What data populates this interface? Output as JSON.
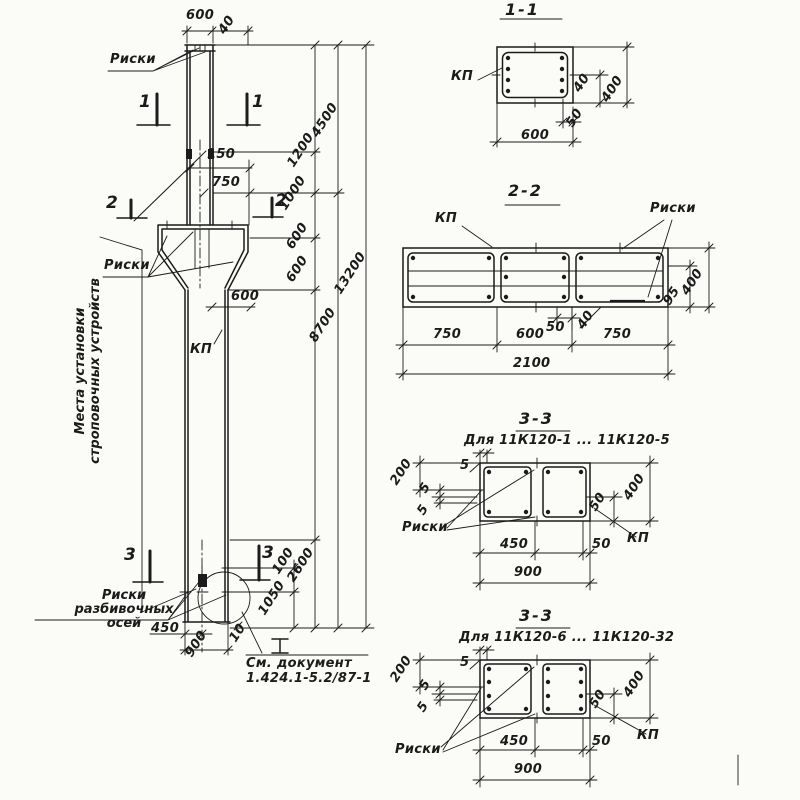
{
  "d": {
    "elev": {
      "w600top": "600",
      "off40": "40",
      "riski_top": "Риски",
      "s1": "1",
      "d150": "150",
      "d750": "750",
      "s2": "2",
      "riski_k": "Риски",
      "w600k": "600",
      "kp": "КП",
      "strop1": "Места установки",
      "strop2": "строповочных устройств",
      "s3": "3",
      "ra1": "Риски",
      "ra2": "разбивочных",
      "ra3": "осей",
      "d450": "450",
      "d900": "900",
      "d10": "10",
      "d100": "100",
      "d1050": "1050",
      "d2600": "2600",
      "d1200": "1200",
      "d1000": "1000",
      "d600a": "600",
      "d600b": "600",
      "d4500": "4500",
      "d8700": "8700",
      "d13200": "13200",
      "doc1": "См. документ",
      "doc2": "1.424.1-5.2/87-1"
    },
    "s11": {
      "title": "1-1",
      "kp": "КП",
      "d40": "40",
      "d400": "400",
      "d50": "50",
      "d600": "600"
    },
    "s22": {
      "title": "2-2",
      "kp": "КП",
      "riski": "Риски",
      "d50": "50",
      "d40": "40",
      "d95": "95",
      "d400": "400",
      "d750a": "750",
      "d600": "600",
      "d750b": "750",
      "d2100": "2100"
    },
    "s33a": {
      "title": "3-3",
      "subtitle": "Для 11К120-1 ... 11К120-5",
      "riski": "Риски",
      "kp": "КП",
      "d200": "200",
      "d5a": "5",
      "d5b": "5",
      "d5t": "5",
      "d450": "450",
      "d50r": "50",
      "d50b": "50",
      "d400": "400",
      "d900": "900"
    },
    "s33b": {
      "title": "3-3",
      "subtitle": "Для 11К120-6 ... 11К120-32",
      "riski": "Риски",
      "kp": "КП",
      "d200": "200",
      "d5a": "5",
      "d5b": "5",
      "d5t": "5",
      "d450": "450",
      "d50r": "50",
      "d50b": "50",
      "d400": "400",
      "d900": "900"
    }
  }
}
